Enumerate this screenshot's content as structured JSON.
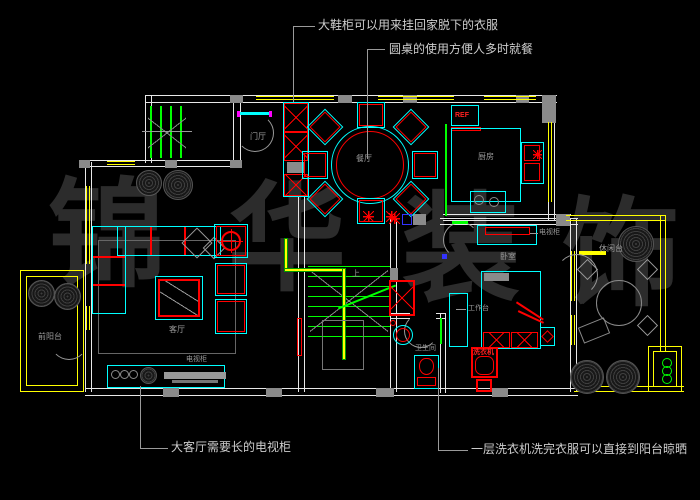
{
  "watermark": {
    "text": "锦华装饰",
    "chars": [
      "锦",
      "华",
      "装",
      "饰"
    ]
  },
  "annotations": {
    "shoe_cabinet": "大鞋柜可以用来挂回家脱下的衣服",
    "round_table": "圆桌的使用方便人多时就餐",
    "tv_cabinet": "大客厅需要长的电视柜",
    "washing_machine": "一层洗衣机洗完衣服可以直接到阳台晾晒"
  },
  "rooms": {
    "foyer": "门厅",
    "dining": "餐厅",
    "kitchen": "厨房",
    "living": "客厅",
    "bedroom": "卧室",
    "bathroom": "卫生间",
    "front_balcony": "前阳台",
    "terrace": "休闲台"
  },
  "furniture": {
    "fridge": "REF",
    "bedroom_tv_cabinet": "电视柜",
    "living_tv_cabinet": "电视柜",
    "desk": "工作台",
    "washer": "洗衣机",
    "stairs_up": "上"
  },
  "colors": {
    "background": "#000000",
    "wall": "#e8e8e8",
    "window": "#ffff00",
    "furniture": "#00ffff",
    "accent": "#ff0000",
    "stairs_door": "#00ff00",
    "annotation": "#cdcdcd",
    "watermark": "#2c2c2c"
  }
}
